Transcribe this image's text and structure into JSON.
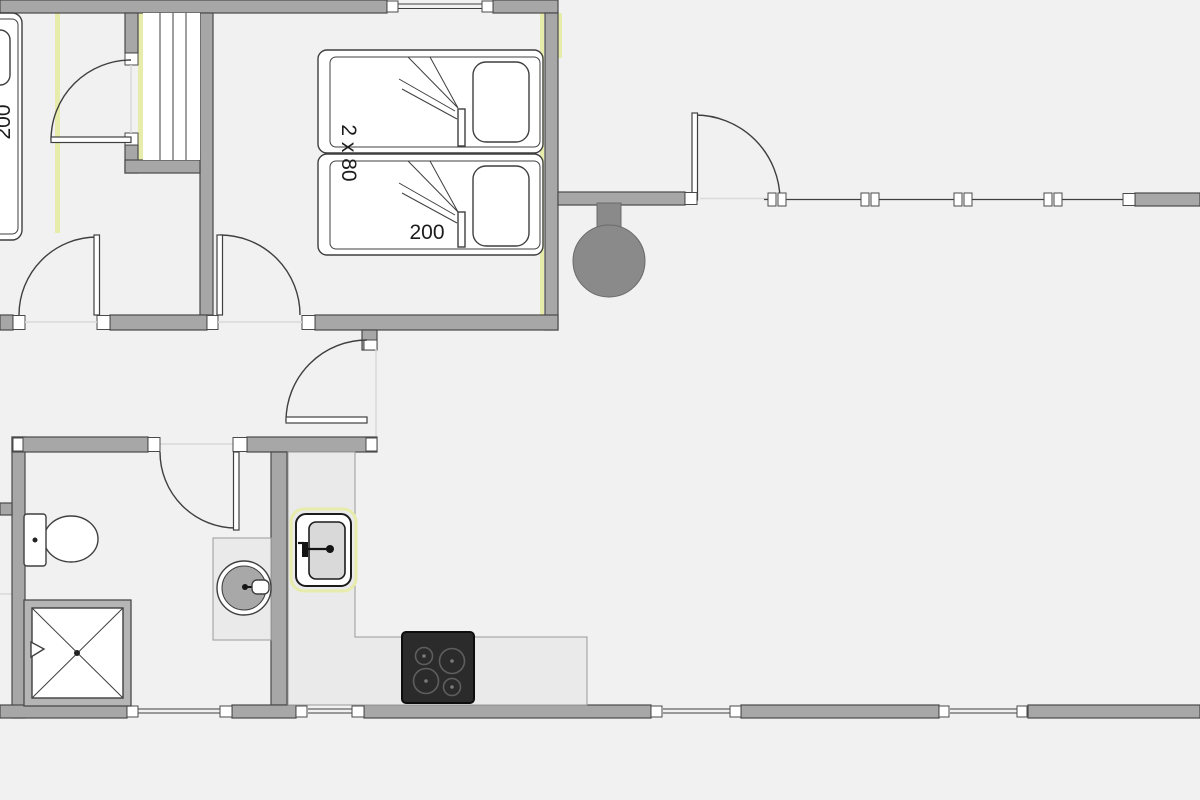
{
  "floorplan": {
    "labels": {
      "bedroom_bed_width": "2 x 80",
      "bedroom_bed_length": "200",
      "left_bed_length": "200"
    },
    "colors": {
      "bg": "#f1f1f1",
      "wall-fill": "#a7a7a7",
      "wall-stroke": "#4a4a4a",
      "line": "#3f3f3f",
      "fixture-fill": "#ffffff",
      "highlight": "#e7ecaa",
      "counter-fill": "#eaeaea",
      "counter-stroke": "#9a9a9a",
      "stove-fill": "#2b2b2b",
      "burner-ring": "#5e5e5e",
      "outdoor-fill": "#8a8a8a",
      "threshold": "#d9d9d9",
      "label-color": "#1c1c1c"
    }
  }
}
